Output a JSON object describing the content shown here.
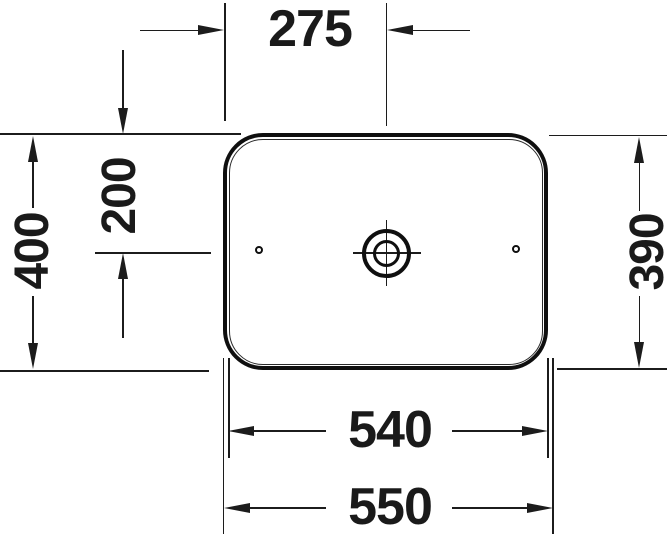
{
  "drawing": {
    "subject": "washbasin-top-view-technical-drawing",
    "background_color": "#ffffff",
    "line_color": "#1c1c1c",
    "dimensions": {
      "faucet_offset_x": "275",
      "drain_offset_y": "200",
      "overall_depth": "400",
      "basin_depth": "390",
      "basin_width": "540",
      "overall_width": "550"
    }
  }
}
